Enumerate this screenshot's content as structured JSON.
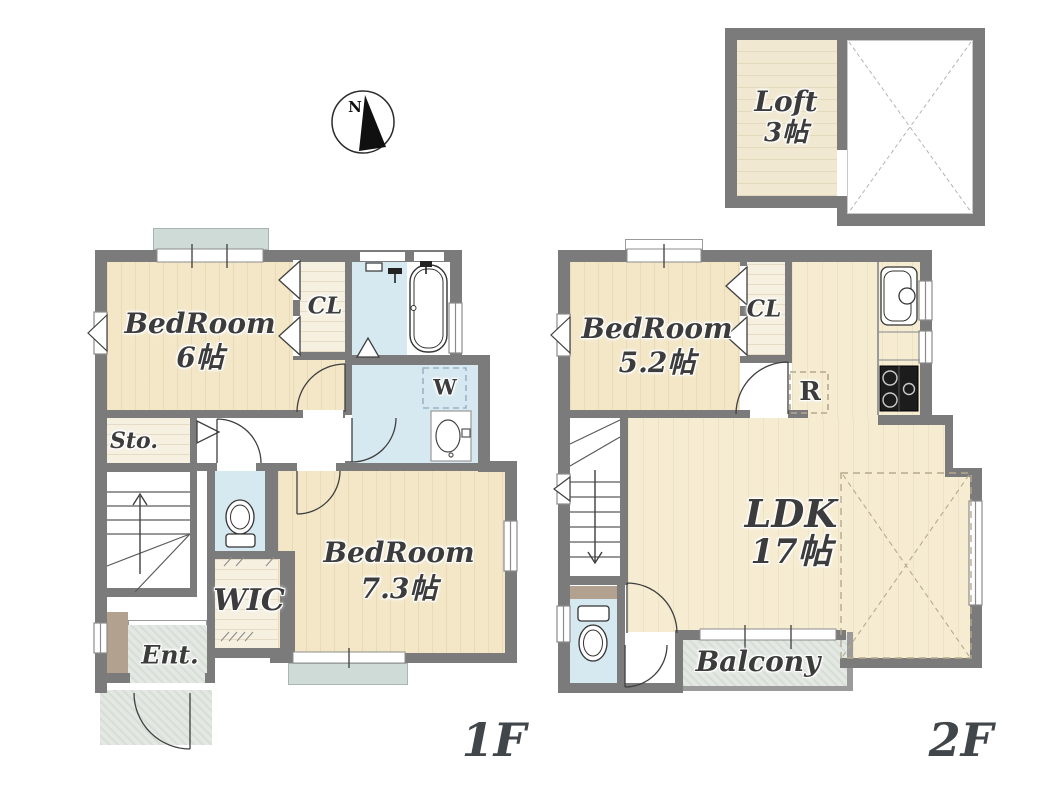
{
  "compass": {
    "north_label": "N"
  },
  "floor1": {
    "label": "1F",
    "rooms": {
      "bedroom6": {
        "name": "BedRoom",
        "size": "6帖"
      },
      "closet": {
        "label": "CL"
      },
      "storage": {
        "label": "Sto."
      },
      "walk_in_closet": {
        "label": "WIC"
      },
      "entrance": {
        "label": "Ent."
      },
      "bedroom73": {
        "name": "BedRoom",
        "size": "7.3帖"
      },
      "washer_area": {
        "label": "W"
      }
    }
  },
  "floor2": {
    "label": "2F",
    "rooms": {
      "bedroom52": {
        "name": "BedRoom",
        "size": "5.2帖"
      },
      "closet": {
        "label": "CL"
      },
      "refrigerator_area": {
        "label": "R"
      },
      "ldk": {
        "name": "LDK",
        "size": "17帖"
      },
      "balcony": {
        "label": "Balcony"
      }
    }
  },
  "loft": {
    "name": "Loft",
    "size": "3帖"
  },
  "icons": {
    "compass": "compass-north-needle",
    "bathtub": "bathtub-outline",
    "toilet": "toilet-bowl-with-tank",
    "washbasin": "oval-basin",
    "kitchen_sink": "sink-with-faucet-circle",
    "stove": "three-burner-stove",
    "washing_machine_area": "dashed-square-W",
    "refrigerator_area": "dashed-square-R",
    "stairs_up": "treads-with-up-arrow",
    "stairs_down": "treads-with-down-arrow",
    "door": "quarter-circle-swing-arc",
    "window": "white-double-line-in-wall"
  },
  "colors": {
    "wall": "#7b7b7b",
    "wood_floor": "#f3e7c8",
    "ldk_floor": "#f6ecd2",
    "wet_floor": "#d6e8f0",
    "closet_floor": "#f6f0e1",
    "paving": "#e3e8e2",
    "window_sill": "#cfdbd6",
    "step_brown": "#b3a18f",
    "label_text": "#3c3c3c"
  }
}
